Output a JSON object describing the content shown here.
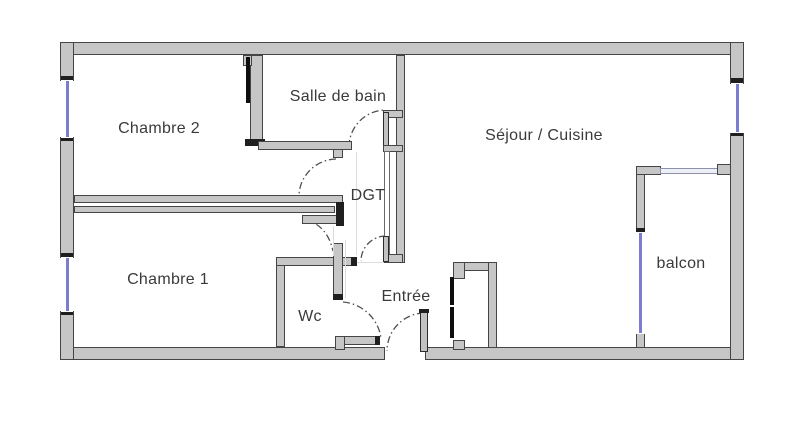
{
  "title": "Apartment floor plan",
  "colors": {
    "wall_fill": "#c6c6c6",
    "wall_border": "#454545",
    "window_glass": "#7b7dd2",
    "door_leaf": "#0e0e0e",
    "arc_stroke": "#4f4f4f",
    "label_text": "#3a3a3a",
    "background": "#ffffff"
  },
  "rooms": [
    {
      "id": "chambre-2",
      "label": "Chambre 2",
      "cx": 159,
      "cy": 129
    },
    {
      "id": "salle-de-bain",
      "label": "Salle de bain",
      "cx": 338,
      "cy": 97
    },
    {
      "id": "sejour-cuisine",
      "label": "Séjour / Cuisine",
      "cx": 544,
      "cy": 136
    },
    {
      "id": "dgt",
      "label": "DGT",
      "cx": 368,
      "cy": 196
    },
    {
      "id": "chambre-1",
      "label": "Chambre 1",
      "cx": 168,
      "cy": 280
    },
    {
      "id": "wc",
      "label": "Wc",
      "cx": 310,
      "cy": 317
    },
    {
      "id": "entree",
      "label": "Entrée",
      "cx": 406,
      "cy": 297
    },
    {
      "id": "balcon",
      "label": "balcon",
      "cx": 681,
      "cy": 264
    }
  ],
  "walls": [
    {
      "name": "outer-wall-top",
      "type": "wall",
      "x": 60,
      "y": 42,
      "w": 684,
      "h": 13
    },
    {
      "name": "outer-wall-bottom-left",
      "type": "wall",
      "x": 60,
      "y": 347,
      "w": 325,
      "h": 13
    },
    {
      "name": "outer-wall-bottom-right",
      "type": "wall",
      "x": 425,
      "y": 347,
      "w": 319,
      "h": 13
    },
    {
      "name": "outer-wall-left-upper",
      "type": "wall",
      "x": 60,
      "y": 42,
      "w": 14,
      "h": 39
    },
    {
      "name": "outer-wall-left-middle",
      "type": "wall",
      "x": 60,
      "y": 137,
      "w": 14,
      "h": 121
    },
    {
      "name": "outer-wall-left-lower",
      "type": "wall",
      "x": 60,
      "y": 311,
      "w": 14,
      "h": 49
    },
    {
      "name": "outer-wall-right-upper",
      "type": "wall",
      "x": 730,
      "y": 42,
      "w": 14,
      "h": 42
    },
    {
      "name": "outer-wall-right-lower",
      "type": "wall",
      "x": 730,
      "y": 133,
      "w": 14,
      "h": 227
    },
    {
      "name": "bathroom-left-wall",
      "type": "wall",
      "x": 250,
      "y": 55,
      "w": 13,
      "h": 91
    },
    {
      "name": "bathroom-left-wall-top-stub",
      "type": "wall",
      "x": 243,
      "y": 55,
      "w": 9,
      "h": 11
    },
    {
      "name": "bathroom-left-wall-bottom-cap",
      "type": "cap",
      "x": 245,
      "y": 139,
      "w": 20,
      "h": 7
    },
    {
      "name": "chambre2-door-leaf",
      "type": "leaf",
      "x": 246,
      "y": 57,
      "w": 4,
      "h": 46
    },
    {
      "name": "bathroom-bottom-wall",
      "type": "wall",
      "x": 258,
      "y": 141,
      "w": 94,
      "h": 9
    },
    {
      "name": "bathroom-door-jamb-stub",
      "type": "wall",
      "x": 333,
      "y": 149,
      "w": 10,
      "h": 9
    },
    {
      "name": "sejour-left-wall",
      "type": "wall",
      "x": 396,
      "y": 55,
      "w": 9,
      "h": 208
    },
    {
      "name": "dgt-north-jamb-upper",
      "type": "wall",
      "x": 383,
      "y": 110,
      "w": 20,
      "h": 8
    },
    {
      "name": "bathroom-door-leaf",
      "type": "gleaf",
      "x": 383,
      "y": 112,
      "w": 6,
      "h": 34
    },
    {
      "name": "dgt-north-jamb-lower",
      "type": "wall",
      "x": 383,
      "y": 145,
      "w": 20,
      "h": 7
    },
    {
      "name": "dgt-east-thin-wall",
      "type": "thin",
      "x": 384,
      "y": 151,
      "w": 6,
      "h": 104
    },
    {
      "name": "dgt-south-jamb",
      "type": "wall",
      "x": 383,
      "y": 254,
      "w": 20,
      "h": 9
    },
    {
      "name": "dgt-south-door-leaf",
      "type": "gleaf",
      "x": 383,
      "y": 236,
      "w": 6,
      "h": 26
    },
    {
      "name": "bedroom-divider-wall-upper",
      "type": "wall",
      "x": 74,
      "y": 195,
      "w": 269,
      "h": 8
    },
    {
      "name": "bedroom-divider-wall-lower",
      "type": "wall",
      "x": 74,
      "y": 206,
      "w": 261,
      "h": 7
    },
    {
      "name": "bedroom-divider-wall-end",
      "type": "wall",
      "x": 302,
      "y": 215,
      "w": 41,
      "h": 9
    },
    {
      "name": "bedroom-divider-end-cap",
      "type": "cap",
      "x": 336,
      "y": 202,
      "w": 8,
      "h": 24
    },
    {
      "name": "wc-left-wall",
      "type": "wall",
      "x": 276,
      "y": 260,
      "w": 9,
      "h": 87
    },
    {
      "name": "wc-top-wall",
      "type": "wall",
      "x": 276,
      "y": 257,
      "w": 81,
      "h": 9
    },
    {
      "name": "wc-top-wall-end-cap",
      "type": "cap",
      "x": 351,
      "y": 257,
      "w": 6,
      "h": 9
    },
    {
      "name": "wc-right-wall",
      "type": "wall",
      "x": 333,
      "y": 243,
      "w": 10,
      "h": 57
    },
    {
      "name": "wc-right-wall-bottom-cap",
      "type": "cap",
      "x": 333,
      "y": 294,
      "w": 10,
      "h": 6
    },
    {
      "name": "wc-bottom-wall",
      "type": "wall",
      "x": 335,
      "y": 336,
      "w": 45,
      "h": 9
    },
    {
      "name": "wc-bottom-wall-stub",
      "type": "wall",
      "x": 335,
      "y": 336,
      "w": 10,
      "h": 14
    },
    {
      "name": "wc-bottom-wall-end-cap",
      "type": "cap",
      "x": 375,
      "y": 336,
      "w": 5,
      "h": 9
    },
    {
      "name": "closet-top-wall",
      "type": "wall",
      "x": 453,
      "y": 262,
      "w": 44,
      "h": 9
    },
    {
      "name": "closet-right-wall",
      "type": "wall",
      "x": 488,
      "y": 262,
      "w": 9,
      "h": 86
    },
    {
      "name": "closet-top-left-stub",
      "type": "wall",
      "x": 453,
      "y": 262,
      "w": 12,
      "h": 17
    },
    {
      "name": "closet-bottom-left-stub",
      "type": "wall",
      "x": 453,
      "y": 340,
      "w": 12,
      "h": 10
    },
    {
      "name": "closet-door-leaf-upper",
      "type": "leaf",
      "x": 450,
      "y": 277,
      "w": 4,
      "h": 28
    },
    {
      "name": "closet-door-leaf-lower",
      "type": "leaf",
      "x": 450,
      "y": 307,
      "w": 4,
      "h": 31
    },
    {
      "name": "entry-door-leaf",
      "type": "gleaf",
      "x": 420,
      "y": 311,
      "w": 8,
      "h": 41
    },
    {
      "name": "entry-door-leaf-cap",
      "type": "cap",
      "x": 419,
      "y": 309,
      "w": 10,
      "h": 4
    },
    {
      "name": "balcony-left-wall-upper",
      "type": "wall",
      "x": 636,
      "y": 166,
      "w": 9,
      "h": 67
    },
    {
      "name": "balcony-top-corner",
      "type": "wall",
      "x": 636,
      "y": 166,
      "w": 25,
      "h": 9
    },
    {
      "name": "balcony-left-wall-lower-stub",
      "type": "wall",
      "x": 636,
      "y": 333,
      "w": 9,
      "h": 15
    },
    {
      "name": "balcony-window-top-cap",
      "type": "cap",
      "x": 636,
      "y": 228,
      "w": 9,
      "h": 5
    },
    {
      "name": "balcony-railing",
      "type": "rail",
      "x": 660,
      "y": 168,
      "w": 58,
      "h": 6
    },
    {
      "name": "balcony-railing-right-stub",
      "type": "wall",
      "x": 717,
      "y": 164,
      "w": 14,
      "h": 11
    },
    {
      "name": "window-tick-left-1a",
      "type": "cap",
      "x": 61,
      "y": 76,
      "w": 12,
      "h": 5
    },
    {
      "name": "window-tick-left-1b",
      "type": "cap",
      "x": 61,
      "y": 137,
      "w": 12,
      "h": 4
    },
    {
      "name": "window-tick-left-2a",
      "type": "cap",
      "x": 61,
      "y": 253,
      "w": 12,
      "h": 5
    },
    {
      "name": "window-tick-left-2b",
      "type": "cap",
      "x": 61,
      "y": 311,
      "w": 12,
      "h": 4
    },
    {
      "name": "window-tick-right-a",
      "type": "cap",
      "x": 731,
      "y": 78,
      "w": 12,
      "h": 6
    },
    {
      "name": "window-tick-right-b",
      "type": "cap",
      "x": 731,
      "y": 132,
      "w": 12,
      "h": 4
    }
  ],
  "windows": [
    {
      "name": "window-chambre2",
      "x": 61,
      "y": 80,
      "w": 12,
      "h": 58,
      "line": {
        "x": 66,
        "y": 81,
        "w": 3,
        "h": 56
      }
    },
    {
      "name": "window-chambre1",
      "x": 61,
      "y": 257,
      "w": 12,
      "h": 55,
      "line": {
        "x": 66,
        "y": 258,
        "w": 3,
        "h": 53
      }
    },
    {
      "name": "window-sejour",
      "x": 731,
      "y": 83,
      "w": 12,
      "h": 50,
      "line": {
        "x": 736,
        "y": 84,
        "w": 3,
        "h": 48
      }
    },
    {
      "name": "window-balcon-door",
      "x": 636,
      "y": 232,
      "w": 9,
      "h": 102,
      "line": {
        "x": 639,
        "y": 233,
        "w": 3,
        "h": 100
      }
    }
  ],
  "door_arcs": [
    {
      "name": "door-arc-salle-de-bain",
      "path": "M 349 147 A 37 37 0 0 1 386 110"
    },
    {
      "name": "door-arc-chambre-2",
      "path": "M 336 159 A 38 38 0 0 0 299 194"
    },
    {
      "name": "door-arc-chambre-1",
      "path": "M 303 219 Q 327 224 333 251"
    },
    {
      "name": "door-arc-dgt-south",
      "path": "M 386 236 A 25 25 0 0 0 361 261"
    },
    {
      "name": "door-arc-wc",
      "path": "M 343 302 A 42 42 0 0 1 381 338"
    },
    {
      "name": "door-arc-entree",
      "path": "M 424 313 A 38 38 0 0 0 387 351"
    }
  ],
  "faint_lines": [
    {
      "name": "room-boundary-dgt",
      "x": 356,
      "y": 152,
      "w": 1,
      "h": 103
    },
    {
      "name": "room-boundary-wc-east",
      "x": 345,
      "y": 240,
      "w": 1,
      "h": 58
    },
    {
      "name": "room-boundary-entree-north",
      "x": 357,
      "y": 262,
      "w": 27,
      "h": 1
    },
    {
      "name": "room-boundary-entree-west",
      "x": 333,
      "y": 226,
      "w": 1,
      "h": 30
    }
  ]
}
